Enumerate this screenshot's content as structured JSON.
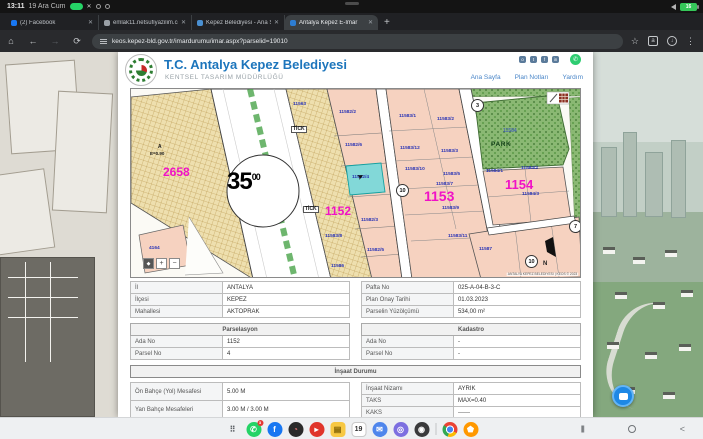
{
  "status_bar": {
    "time": "13:11",
    "date": "19 Ara Cum",
    "battery": "16"
  },
  "browser": {
    "tabs": [
      {
        "label": "(2) Facebook",
        "favicon": "facebook",
        "color": "#1877f2",
        "active": false
      },
      {
        "label": "emlak11.netsufiyazilim.co",
        "favicon": "globe",
        "color": "#9aa0a6",
        "active": false
      },
      {
        "label": "Kepez Belediyesi - Ana Sa",
        "favicon": "kepez",
        "color": "#4a90d2",
        "active": false
      },
      {
        "label": "Antalya Kepez E-İmar",
        "favicon": "keos",
        "color": "#2d7dd2",
        "active": true
      }
    ],
    "close_glyph": "✕",
    "new_tab_glyph": "+",
    "home_glyph": "⌂",
    "back_glyph": "←",
    "forward_glyph": "→",
    "reload_glyph": "⟳",
    "star_glyph": "☆",
    "translate_glyph": "a",
    "download_glyph": "↓",
    "menu_glyph": "⋮",
    "url": "keos.kepez-bld.gov.tr/imardurumu/imar.aspx?parselid=19010"
  },
  "site_header": {
    "title": "T.C. Antalya Kepez Belediyesi",
    "subtitle": "KENTSEL TASARIM MÜDÜRLÜĞÜ",
    "social": [
      {
        "name": "instagram",
        "g": "o"
      },
      {
        "name": "twitter",
        "g": "t"
      },
      {
        "name": "facebook",
        "g": "f"
      },
      {
        "name": "linkedin",
        "g": "in"
      }
    ],
    "whatsapp_glyph": "✆",
    "nav": [
      "Ana Sayfa",
      "Plan Notları",
      "Yardım"
    ]
  },
  "map": {
    "road_width": {
      "main": "35",
      "sup": "00"
    },
    "labels": [
      {
        "t": "2658",
        "x": 44,
        "y": 77,
        "cls": "mag",
        "s": 12
      },
      {
        "t": "1152",
        "x": 206,
        "y": 116,
        "cls": "mag",
        "s": 12
      },
      {
        "t": "1153",
        "x": 305,
        "y": 100,
        "cls": "mag",
        "s": 14
      },
      {
        "t": "1154",
        "x": 386,
        "y": 89,
        "cls": "mag",
        "s": 13
      },
      {
        "t": "A",
        "x": 39,
        "y": 56,
        "cls": "blk",
        "s": 5
      },
      {
        "t": "E=0.90",
        "x": 31,
        "y": 63,
        "cls": "blk",
        "s": 4.5
      },
      {
        "t": "PARK",
        "x": 372,
        "y": 53,
        "cls": "parkl",
        "s": 6.5
      },
      {
        "t": "N",
        "x": 424,
        "y": 172,
        "cls": "blk",
        "s": 6
      },
      {
        "t": "TİCK",
        "x": 172,
        "y": 37,
        "cls": "tick"
      },
      {
        "t": "TİCK",
        "x": 184,
        "y": 117,
        "cls": "tick"
      },
      {
        "t": "11584",
        "x": 384,
        "y": 40,
        "cls": "bluep"
      },
      {
        "t": "11563",
        "x": 174,
        "y": 14,
        "cls": "blue"
      },
      {
        "t": "11582/2",
        "x": 220,
        "y": 22,
        "cls": "blue"
      },
      {
        "t": "11582/6",
        "x": 226,
        "y": 55,
        "cls": "blue"
      },
      {
        "t": "11582/4",
        "x": 233,
        "y": 87,
        "cls": "blue"
      },
      {
        "t": "11582/3",
        "x": 242,
        "y": 130,
        "cls": "blue"
      },
      {
        "t": "11582/5",
        "x": 248,
        "y": 160,
        "cls": "blue"
      },
      {
        "t": "11583/8",
        "x": 206,
        "y": 146,
        "cls": "blue"
      },
      {
        "t": "11586",
        "x": 212,
        "y": 176,
        "cls": "blue"
      },
      {
        "t": "11583/1",
        "x": 280,
        "y": 26,
        "cls": "blue"
      },
      {
        "t": "11583/2",
        "x": 318,
        "y": 29,
        "cls": "blue"
      },
      {
        "t": "11583/12",
        "x": 281,
        "y": 58,
        "cls": "blue"
      },
      {
        "t": "11583/3",
        "x": 322,
        "y": 61,
        "cls": "blue"
      },
      {
        "t": "11583/10",
        "x": 286,
        "y": 79,
        "cls": "blue"
      },
      {
        "t": "11583/5",
        "x": 324,
        "y": 84,
        "cls": "blue"
      },
      {
        "t": "11583/7",
        "x": 317,
        "y": 94,
        "cls": "blue"
      },
      {
        "t": "11583/9",
        "x": 323,
        "y": 118,
        "cls": "blue"
      },
      {
        "t": "11583/11",
        "x": 329,
        "y": 146,
        "cls": "blue"
      },
      {
        "t": "11584/1",
        "x": 367,
        "y": 81,
        "cls": "blue"
      },
      {
        "t": "11584/2",
        "x": 402,
        "y": 78,
        "cls": "blue"
      },
      {
        "t": "11584/3",
        "x": 403,
        "y": 104,
        "cls": "blue"
      },
      {
        "t": "11587",
        "x": 360,
        "y": 159,
        "cls": "blue"
      },
      {
        "t": "4164",
        "x": 30,
        "y": 158,
        "cls": "blue"
      }
    ],
    "road_markers": [
      {
        "t": "10",
        "x": 277,
        "y": 95
      },
      {
        "t": "10",
        "x": 406,
        "y": 166
      },
      {
        "t": "3",
        "x": 352,
        "y": 10
      },
      {
        "t": "7",
        "x": 450,
        "y": 131
      }
    ],
    "zoom_buttons": [
      {
        "g": "◆",
        "name": "map-locate-button",
        "dark": true
      },
      {
        "g": "+",
        "name": "map-zoom-in-button",
        "dark": false
      },
      {
        "g": "−",
        "name": "map-zoom-out-button",
        "dark": false
      }
    ],
    "attribution": "ANTALYA KEPEZ BELEDİYESİ | KEOS © 2023",
    "cursor_glyph": "➤"
  },
  "tables": {
    "location": {
      "rows": [
        [
          "İl",
          "ANTALYA"
        ],
        [
          "İlçesi",
          "KEPEZ"
        ],
        [
          "Mahallesi",
          "AKTOPRAK"
        ]
      ]
    },
    "plan": {
      "rows": [
        [
          "Pafta No",
          "025-A-04-B-3-C"
        ],
        [
          "Plan Onay Tarihi",
          "01.03.2023"
        ],
        [
          "Parselin Yüzölçümü",
          "534,00 m²"
        ]
      ]
    },
    "parselasyon": {
      "title": "Parselasyon",
      "rows": [
        [
          "Ada No",
          "1152"
        ],
        [
          "Parsel No",
          "4"
        ]
      ]
    },
    "kadastro": {
      "title": "Kadastro",
      "rows": [
        [
          "Ada No",
          "-"
        ],
        [
          "Parsel No",
          "-"
        ]
      ]
    },
    "insaat": {
      "title": "İnşaat Durumu",
      "left_rows": [
        [
          "Ön Bahçe (Yol) Mesafesi",
          "5.00 M"
        ],
        [
          "Yan Bahçe Mesafeleri",
          "3.00 M / 3.00 M"
        ]
      ],
      "right_rows": [
        [
          "İnşaat Nizamı",
          "AYRIK"
        ],
        [
          "TAKS",
          "MAX=0.40"
        ],
        [
          "KAKS",
          "------"
        ]
      ]
    }
  },
  "taskbar": {
    "icons": [
      {
        "name": "app-drawer",
        "g": "⠿",
        "bg": "transparent",
        "fg": "#5f6368",
        "sq": true
      },
      {
        "name": "whatsapp",
        "g": "✆",
        "bg": "#25d366",
        "badge": "3"
      },
      {
        "name": "facebook",
        "g": "f",
        "bg": "#1877f2"
      },
      {
        "name": "app-dark",
        "g": "◔",
        "bg": "#2a2a2a",
        "fg": "#e57373"
      },
      {
        "name": "app-red",
        "g": "▸",
        "bg": "#e0352b"
      },
      {
        "name": "notes-yellow",
        "g": "▤",
        "bg": "#f7c843",
        "fg": "#7a5c00",
        "sq": true
      },
      {
        "name": "calendar",
        "g": "19",
        "bg": "#ffffff",
        "fg": "#333333",
        "border": true,
        "sq": true
      },
      {
        "name": "messages",
        "g": "✉",
        "bg": "#4f86ec"
      },
      {
        "name": "samsung-internet",
        "g": "◎",
        "bg": "#7d6fe0"
      },
      {
        "name": "camera",
        "g": "◉",
        "bg": "#3a3a3c"
      },
      {
        "divider": true
      },
      {
        "name": "chrome",
        "g": "",
        "bg": "chrome"
      },
      {
        "name": "gallery",
        "g": "⬟",
        "bg": "#ff9800"
      }
    ],
    "nav": {
      "recents": "|||",
      "back": "<"
    }
  }
}
